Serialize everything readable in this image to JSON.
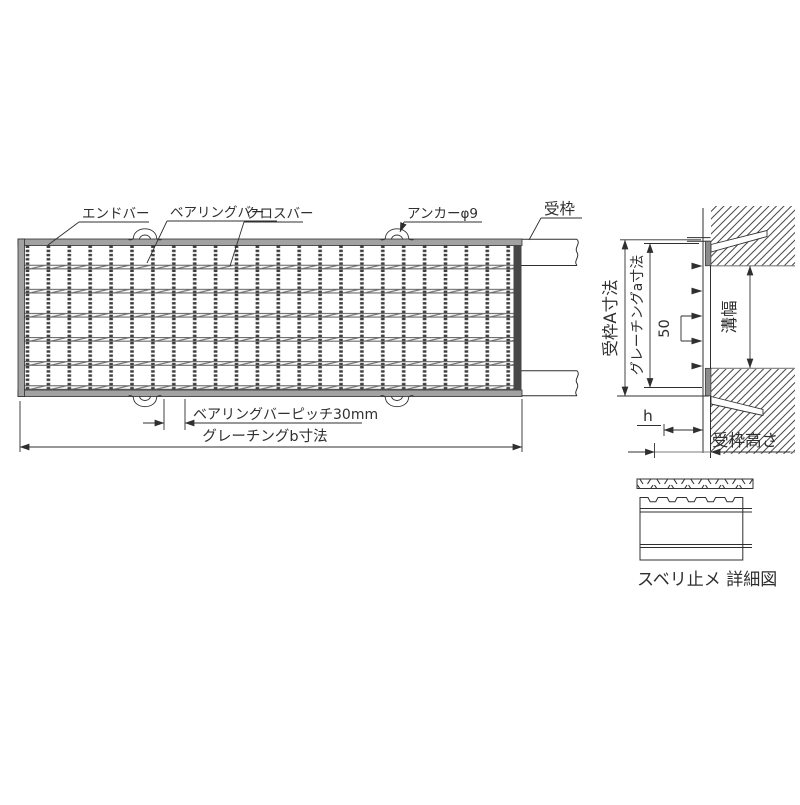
{
  "drawing": {
    "plan_labels": {
      "end_bar": "エンドバー",
      "bearing_bar": "ベアリングバー",
      "cross_bar": "クロスバー",
      "anchor_phi9": "アンカーφ9",
      "frame": "受枠"
    },
    "plan_dims": {
      "bearing_bar_pitch": "ベアリングバーピッチ30mm",
      "grating_b": "グレーチングb寸法"
    },
    "section_dims": {
      "frame_a": "受枠A寸法",
      "grating_a": "グレーチングa寸法",
      "crossbar_pitch": "50",
      "groove_width": "溝幅",
      "h": "h",
      "frame_height": "受枠高さ"
    },
    "detail": {
      "caption": "スベリ止メ 詳細図"
    },
    "colors": {
      "line": "#2f2f2f",
      "gray": "#7d7d7d",
      "band": "#a2a2a2",
      "dark": "#474747"
    }
  }
}
